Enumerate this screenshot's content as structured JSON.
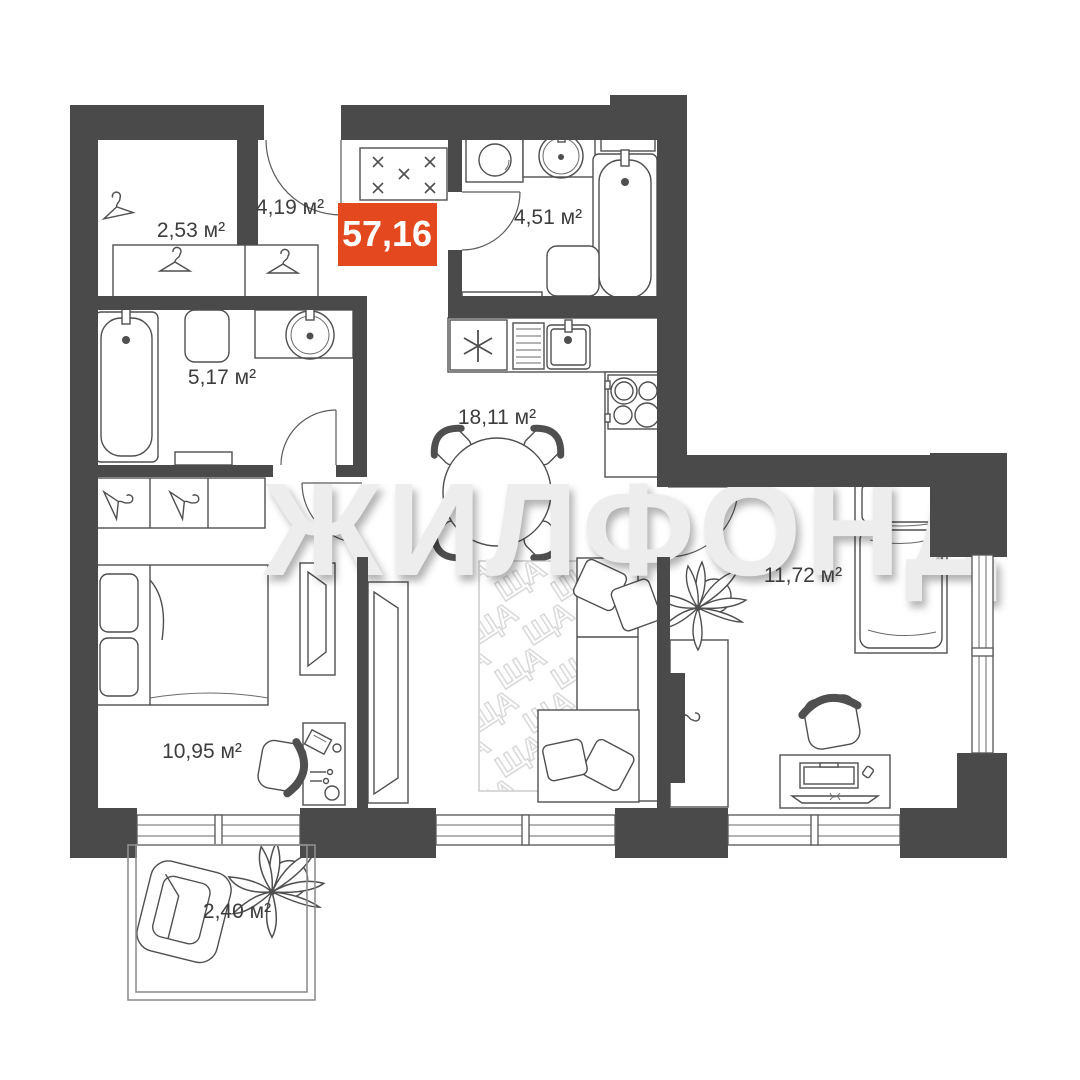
{
  "badge": {
    "total_area": "57,16",
    "color": "#E3481F"
  },
  "watermark": {
    "text": "ЖИЛФОНД",
    "tile": "ЩА"
  },
  "rooms": [
    {
      "id": "hallway",
      "area": "4,19 м²"
    },
    {
      "id": "wardrobe",
      "area": "2,53 м²"
    },
    {
      "id": "bathroom-top",
      "area": "4,51 м²"
    },
    {
      "id": "bathroom-left",
      "area": "5,17 м²"
    },
    {
      "id": "kitchen-living",
      "area": "18,11 м²"
    },
    {
      "id": "bedroom-right",
      "area": "11,72 м²"
    },
    {
      "id": "bedroom-left",
      "area": "10,95 м²"
    },
    {
      "id": "balcony",
      "area": "2,40 м²"
    }
  ],
  "colors": {
    "wall": "#4a4a4a",
    "accent": "#E3481F",
    "watermark": "#ededed"
  }
}
